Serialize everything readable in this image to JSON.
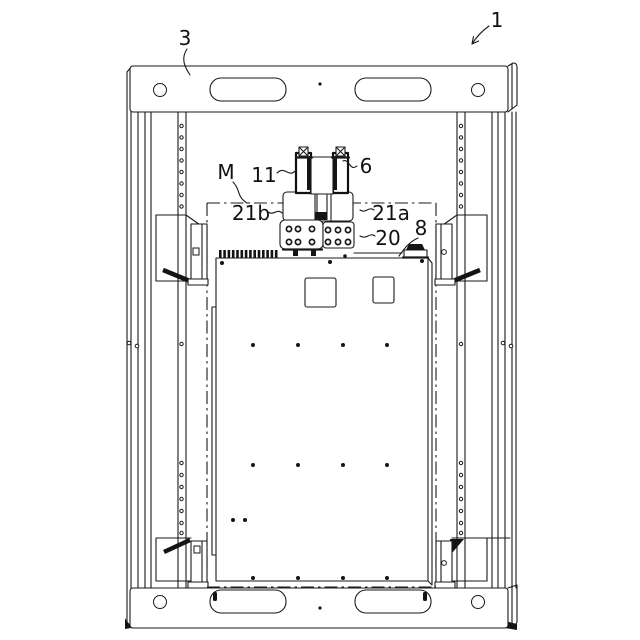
{
  "figure": {
    "kind": "patent-style technical line drawing",
    "subject": "equipment rack frame with mounted plate and clamp assembly"
  },
  "labels": {
    "ref_1": "1",
    "ref_3": "3",
    "ref_m": "M",
    "ref_11": "11",
    "ref_6": "6",
    "ref_21b": "21b",
    "ref_21a": "21a",
    "ref_20": "20",
    "ref_8": "8"
  },
  "colors": {
    "line": "#1a1a1a",
    "dark_fill": "#141414",
    "background": "#ffffff"
  }
}
